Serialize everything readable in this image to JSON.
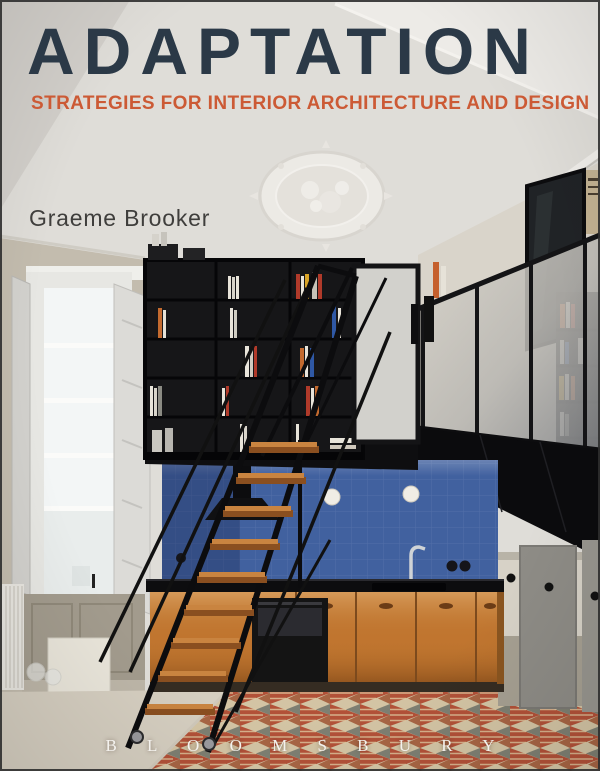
{
  "cover": {
    "title": "ADAPTATION",
    "subtitle": "STRATEGIES FOR INTERIOR ARCHITECTURE AND DESIGN",
    "author": "Graeme Brooker",
    "publisher": "B L O O M S B U R Y"
  },
  "colors": {
    "title_navy": "#2b3947",
    "subtitle_orange": "#cc5a35",
    "author_gray": "#3f3e3c",
    "publisher_white": "#f4f2ee",
    "tile_blue": "#41619f",
    "cabinet_orange": "#c0752f",
    "floor_red": "#b25138",
    "floor_cream": "#d3c4a4",
    "steel_black": "#101012",
    "ceiling_gray": "#dfddd8"
  }
}
